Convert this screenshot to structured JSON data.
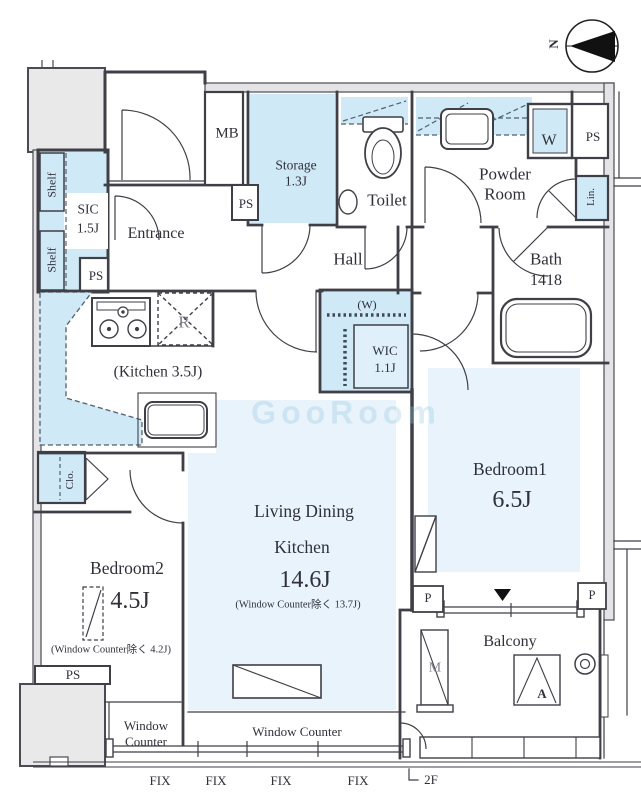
{
  "compass": {
    "north_label": "N"
  },
  "watermark": "GooRoom",
  "rooms": {
    "entrance": {
      "label": "Entrance"
    },
    "hall": {
      "label": "Hall"
    },
    "sic": {
      "label": "SIC",
      "area": "1.5J"
    },
    "storage": {
      "label": "Storage",
      "area": "1.3J"
    },
    "toilet": {
      "label": "Toilet"
    },
    "powder_room": {
      "label_line1": "Powder",
      "label_line2": "Room"
    },
    "bath": {
      "label": "Bath",
      "size": "1418"
    },
    "kitchen": {
      "label": "(Kitchen 3.5J)"
    },
    "wic": {
      "label": "WIC",
      "area": "1.1J",
      "hanger_note": "(W)"
    },
    "ldk": {
      "label_line1": "Living Dining",
      "label_line2": "Kitchen",
      "area": "14.6J",
      "note": "(Window Counter除く 13.7J)"
    },
    "bedroom1": {
      "label": "Bedroom1",
      "area": "6.5J"
    },
    "bedroom2": {
      "label": "Bedroom2",
      "area": "4.5J",
      "note": "(Window Counter除く 4.2J)"
    },
    "balcony": {
      "label": "Balcony"
    }
  },
  "fixtures": {
    "shelf_top": "Shelf",
    "shelf_bottom": "Shelf",
    "meter_box": "MB",
    "washer": "W",
    "linen": "Lin.",
    "refrigerator": "R",
    "closet": "Clo.",
    "meter": "M",
    "air_conditioner": "A"
  },
  "shafts": {
    "ps_entrance": "PS",
    "ps_storage": "PS",
    "ps_powder": "PS",
    "ps_bedroom2": "PS",
    "pipe_left": "P",
    "pipe_right": "P"
  },
  "windows": {
    "counter_small_line1": "Window",
    "counter_small_line2": "Counter",
    "counter_large": "Window Counter",
    "fix_labels": [
      "FIX",
      "FIX",
      "FIX",
      "FIX"
    ]
  },
  "floor_label": "2F",
  "colors": {
    "closet_blue": "#cfe9f7",
    "room_blue": "#e8f3fb",
    "wall": "#3f3f47",
    "common_gray": "#e9e9e9"
  }
}
